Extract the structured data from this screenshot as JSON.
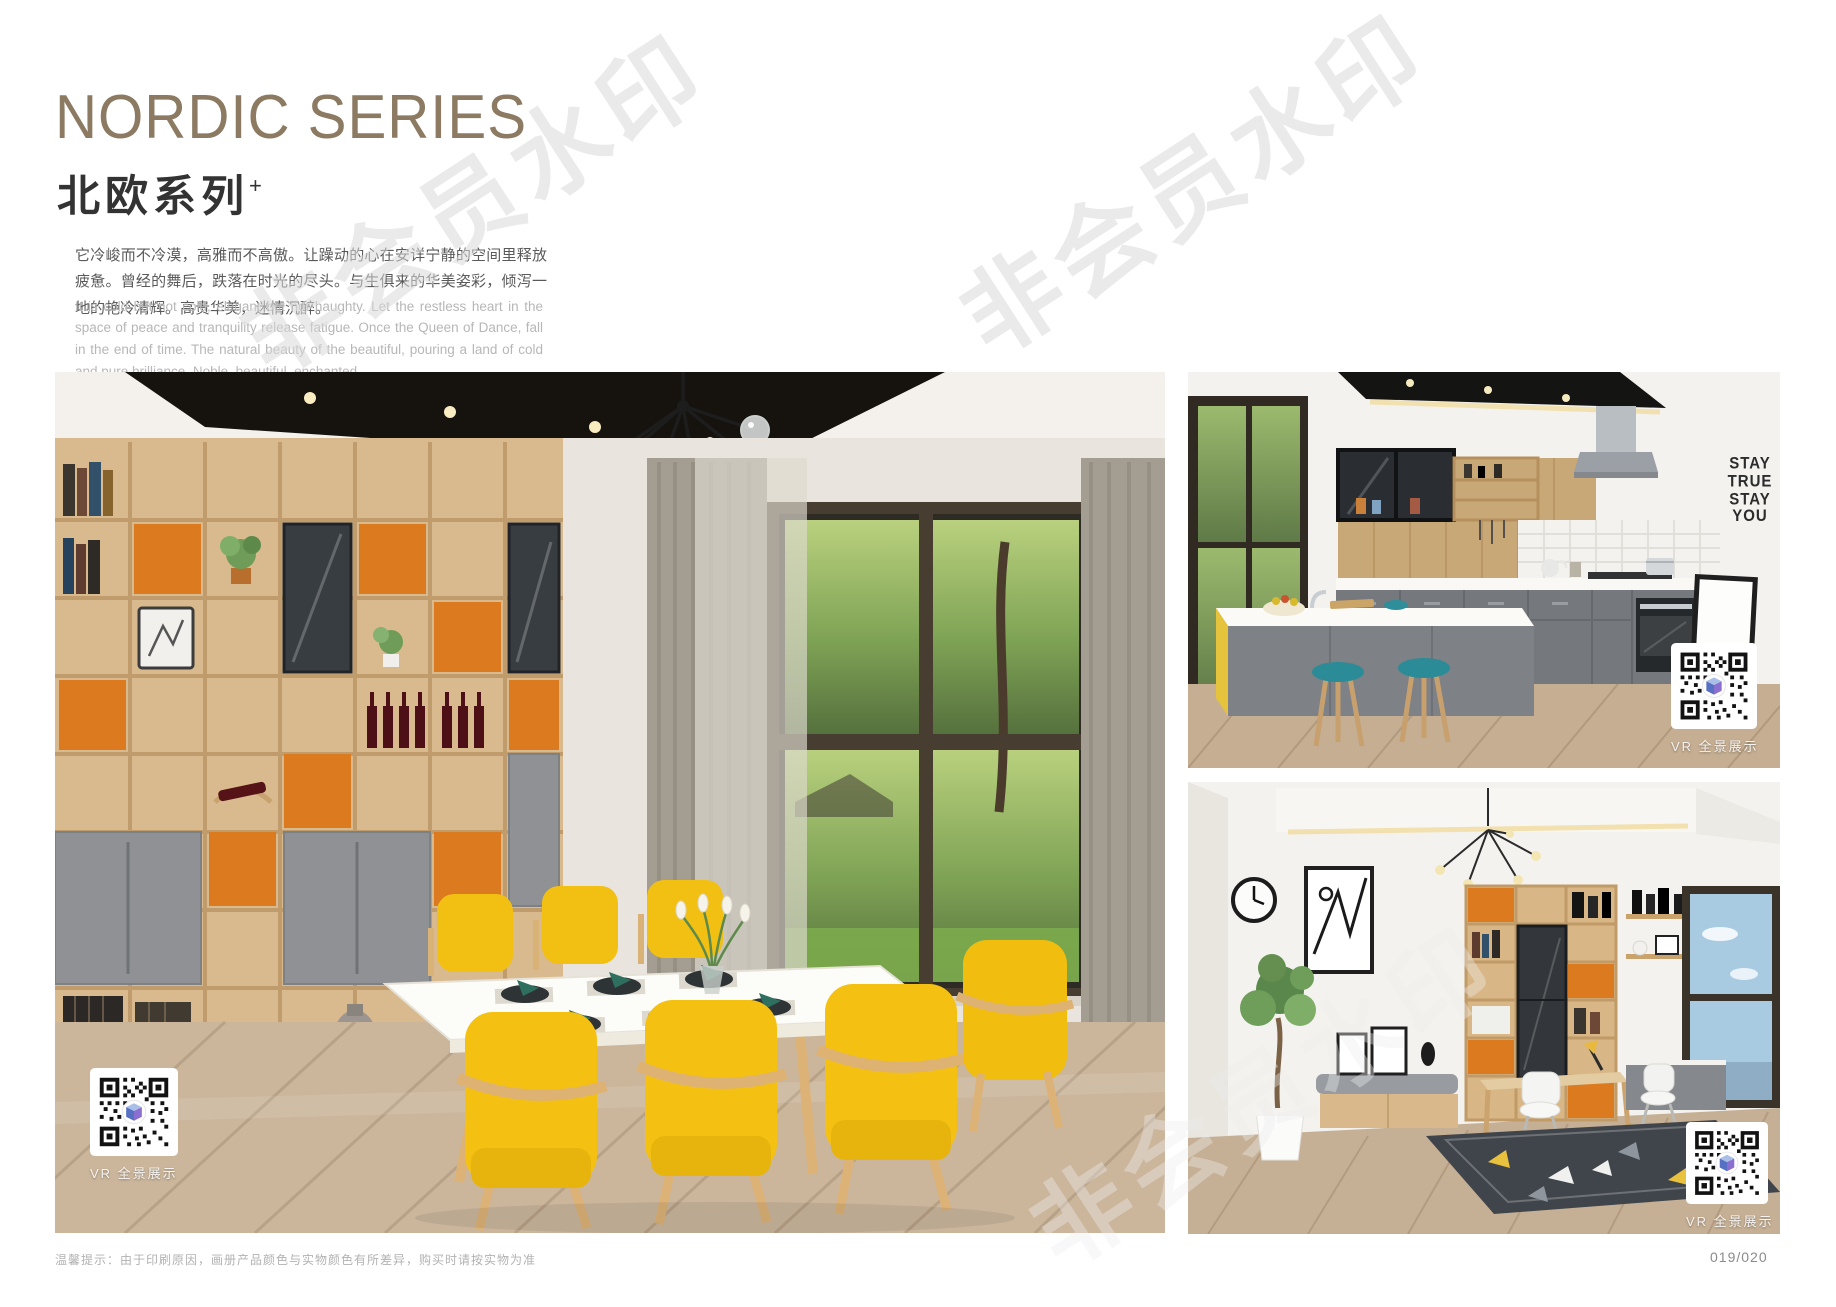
{
  "header": {
    "title_en": "NORDIC SERIES",
    "title_zh": "北欧系列",
    "title_sup": "+",
    "desc_zh": "它冷峻而不冷漠，高雅而不高傲。让躁动的心在安详宁静的空间里释放疲惫。曾经的舞后，跌落在时光的尽头。与生俱来的华美姿彩，倾泻一地的艳冷清辉。高贵华美，迷情沉醉。",
    "desc_en": "It is cold but not cold, elegant but not haughty. Let the restless heart in the space of peace and tranquility release fatigue. Once the Queen of Dance, fall in the end of time. The natural beauty of the beautiful, pouring a land of cold and pure brilliance. Noble, beautiful, enchanted."
  },
  "photos": {
    "vr_label": "VR 全景展示",
    "kitchen_wall_text": "STAY\nTRUE\nSTAY\nYOU"
  },
  "watermark": {
    "text": "非会员水印"
  },
  "footer": {
    "note": "温馨提示：由于印刷原因，画册产品颜色与实物颜色有所差异，购买时请按实物为准",
    "page_number": "019/020"
  },
  "colors": {
    "accent_gold": "#8c7b62",
    "chair_yellow": "#f2c113",
    "cabinet_orange": "#dc7a1f",
    "stool_teal": "#2b8b97"
  }
}
